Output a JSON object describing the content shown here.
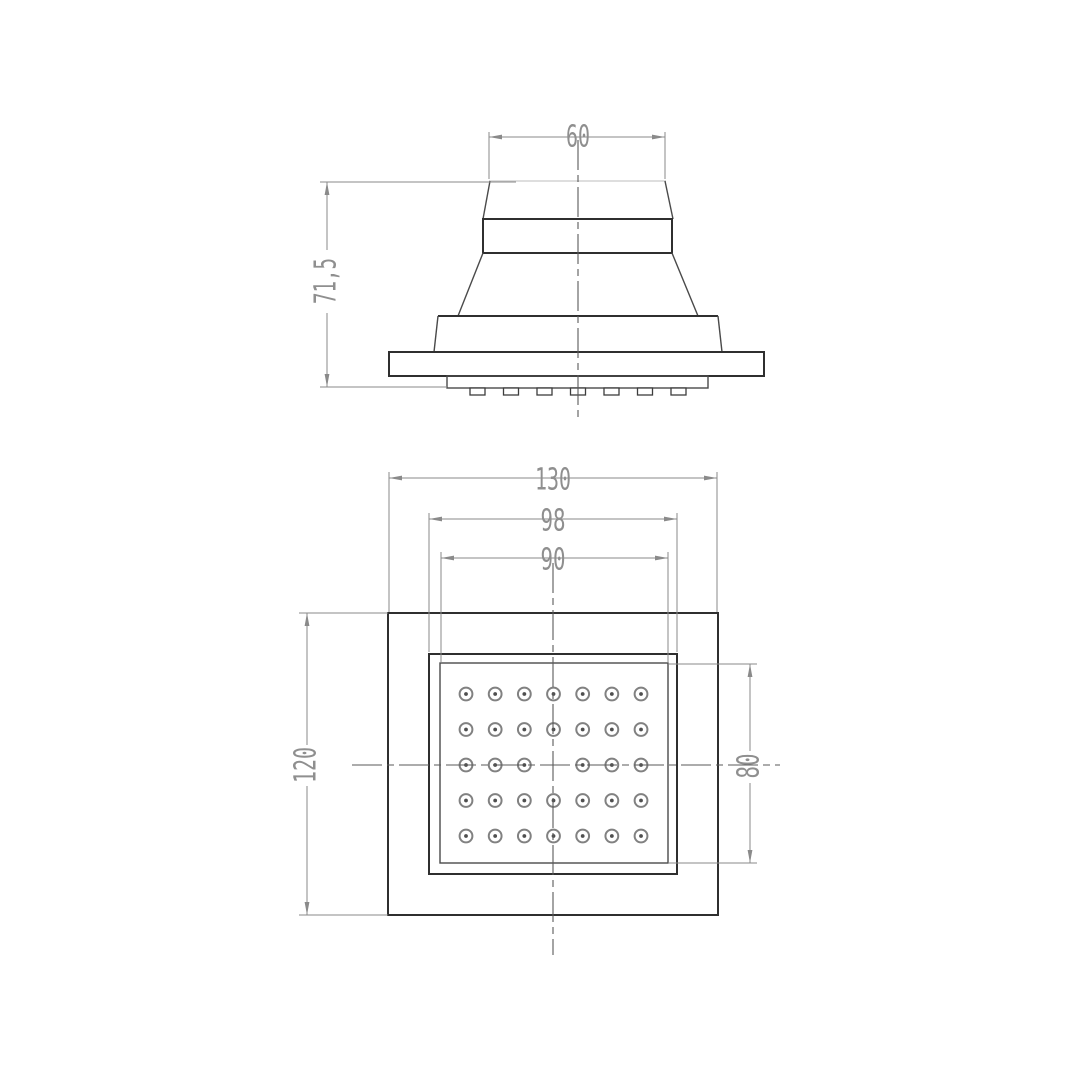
{
  "drawing": {
    "background": "#ffffff",
    "colors": {
      "object_line": "#2f2f2f",
      "medium_line": "#4a4a4a",
      "dimension_line": "#8a8a8a",
      "dimension_text": "#8f8f8f",
      "centerline": "#5a5a5a"
    },
    "side_view": {
      "dim_top_width": "60",
      "dim_height": "71,5",
      "nozzle_stubs": 7
    },
    "plan_view": {
      "dim_outer_width": "130",
      "dim_face_width": "98",
      "dim_nozzle_field_width": "90",
      "dim_outer_height": "120",
      "dim_nozzle_field_height": "80",
      "nozzle_grid": {
        "columns": 7,
        "rows": 5,
        "center_omitted": true,
        "hole_count": 34
      }
    }
  }
}
